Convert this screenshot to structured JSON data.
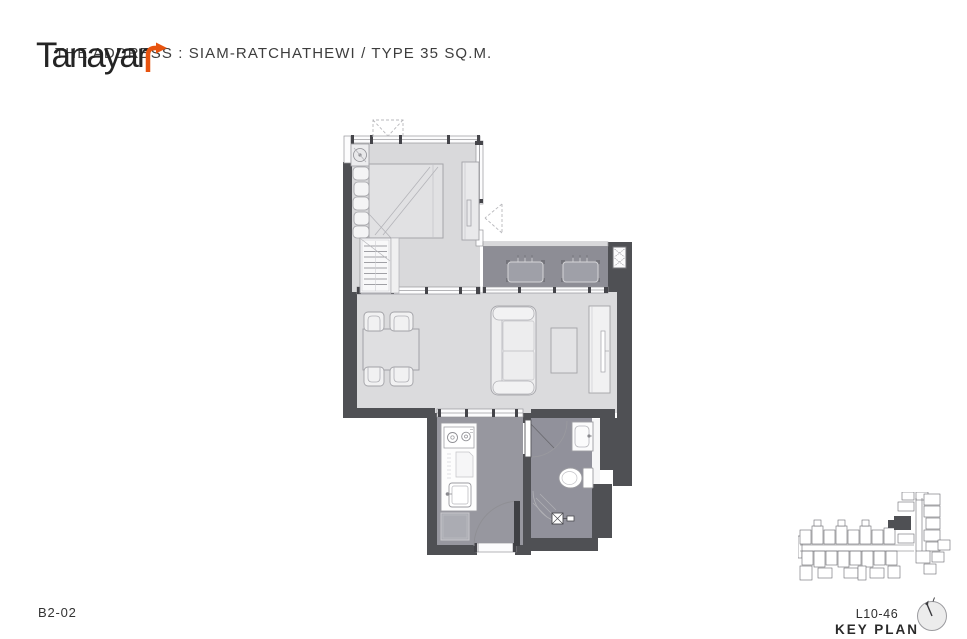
{
  "header": {
    "title": "THE ADDRESS : SIAM-RATCHATHEWI / TYPE 35 SQ.M."
  },
  "logo": {
    "text": "Tanayar",
    "arrow_icon": "bent-arrow-up-right-icon",
    "arrow_color": "#e7530f"
  },
  "floor_plan": {
    "unit_code": "B2-02",
    "depicted_rooms": [
      "bedroom",
      "living-dining",
      "balcony",
      "kitchen",
      "bathroom"
    ],
    "depicted_furniture": [
      "bed",
      "pillows",
      "wardrobe",
      "closet",
      "fan-coil-unit",
      "dining-table",
      "dining-chairs",
      "sofa",
      "coffee-table",
      "tv-console",
      "ac-condensers",
      "louver-vent",
      "kitchen-counter",
      "stove",
      "sink",
      "refrigerator",
      "entry-door",
      "bathroom-door",
      "wash-basin",
      "toilet",
      "shower"
    ]
  },
  "key_plan": {
    "level": "L10-46",
    "caption": "KEY PLAN",
    "compass_icon": "north-compass-icon",
    "highlight_color": "#4f5054"
  },
  "colors": {
    "wall": "#4f5054",
    "floor_light": "#d9d9db",
    "floor_wet": "#97979f",
    "balcony_floor": "#8d8d95",
    "accent_orange": "#e7530f",
    "text": "#3d3d3d"
  }
}
